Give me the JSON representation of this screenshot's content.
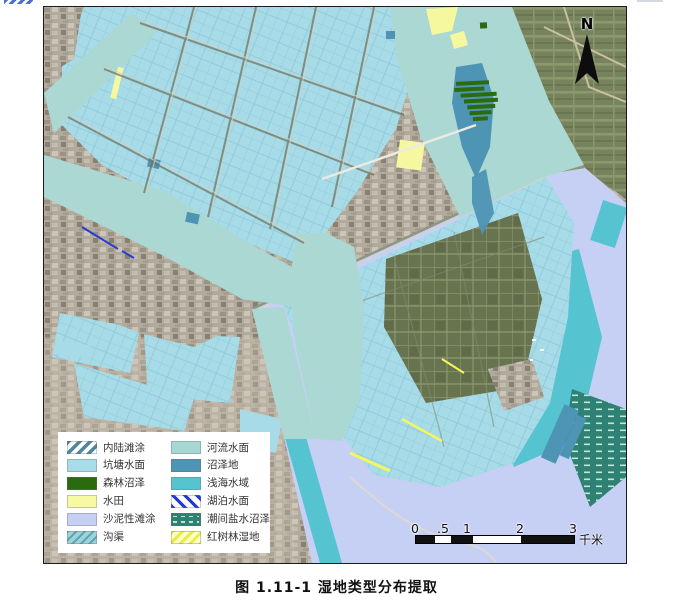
{
  "figure": {
    "caption": "图 1.11-1 湿地类型分布提取"
  },
  "map": {
    "north_label": "N",
    "scale_bar": {
      "labels": [
        "0",
        ".5",
        "1",
        "2",
        "3"
      ],
      "unit": "千米"
    },
    "legend": {
      "items": [
        {
          "label": "内陆滩涂",
          "color": "#4F87A0",
          "pattern": "diagonal-hatch-on-white"
        },
        {
          "label": "坑塘水面",
          "color": "#A8DCE8",
          "pattern": "solid"
        },
        {
          "label": "森林沼泽",
          "color": "#2A6B0E",
          "pattern": "solid"
        },
        {
          "label": "水田",
          "color": "#F7F9A3",
          "pattern": "solid"
        },
        {
          "label": "沙泥性滩涂",
          "color": "#C7D0F4",
          "pattern": "solid"
        },
        {
          "label": "沟渠",
          "color": "#8FC9D3",
          "pattern": "thin-diagonal-hatch"
        },
        {
          "label": "河流水面",
          "color": "#A5D8D3",
          "pattern": "solid"
        },
        {
          "label": "沼泽地",
          "color": "#4E94B5",
          "pattern": "solid"
        },
        {
          "label": "浅海水域",
          "color": "#57C3CE",
          "pattern": "solid"
        },
        {
          "label": "湖泊水面",
          "color": "#2438D8",
          "pattern": "bold-diagonal-hatch-on-white"
        },
        {
          "label": "潮间盐水沼泽",
          "color": "#2F8173",
          "pattern": "horizontal-dashes"
        },
        {
          "label": "红树林湿地",
          "color": "#EDF05A",
          "pattern": "diagonal-hatch-yellow"
        }
      ]
    }
  }
}
